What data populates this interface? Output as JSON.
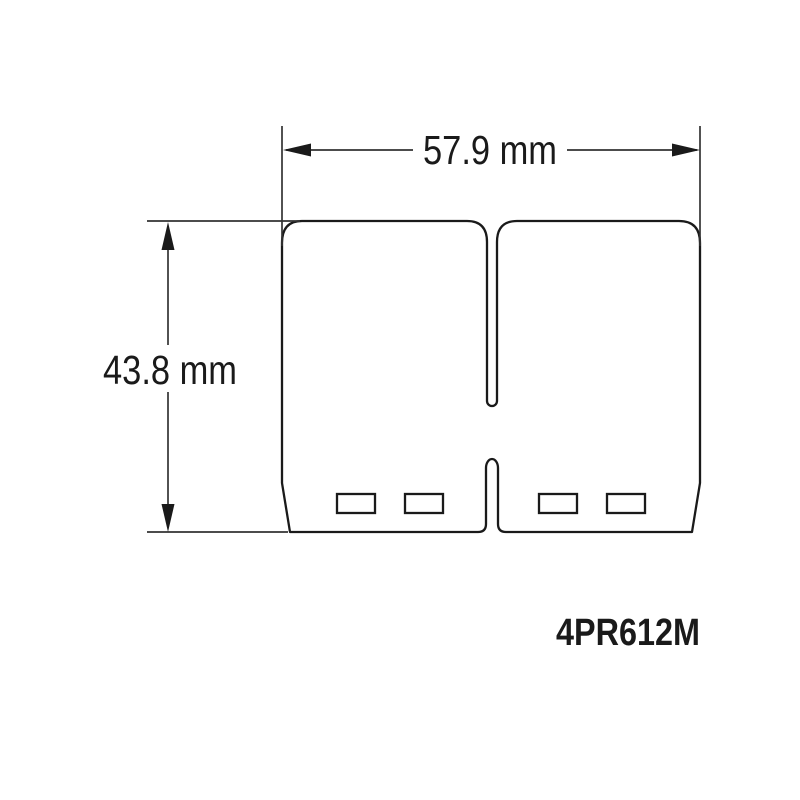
{
  "colors": {
    "background": "#ffffff",
    "line": "#1a1a1a",
    "dim": "#333333",
    "text": "#1a1a1a"
  },
  "drawing": {
    "title": "Reed petal dimensional drawing",
    "width_dimension_label": "57.9 mm",
    "height_dimension_label": "43.8 mm",
    "part_number": "4PR612M"
  }
}
